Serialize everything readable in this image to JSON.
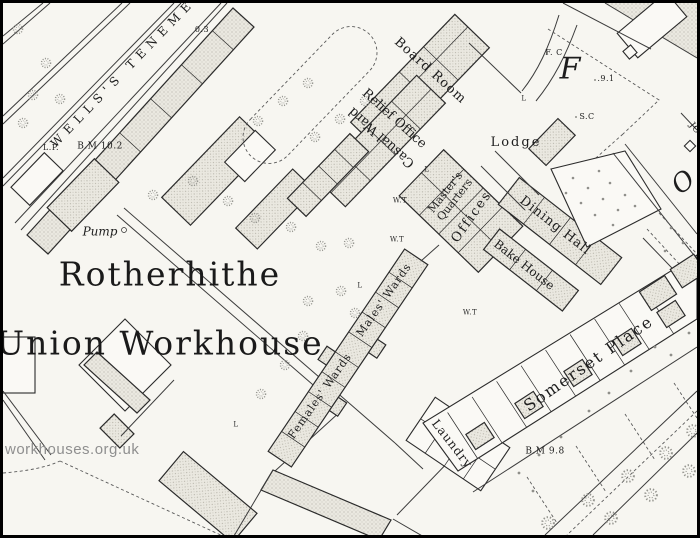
{
  "watermark": "workhouses.org.uk",
  "map": {
    "title": {
      "line1": "Rotherhithe",
      "line2": "Union Workhouse"
    },
    "streets": {
      "wells_tenements": "WELLS'S TENEME",
      "somerset_place": "Somerset Place",
      "big_letter_f": "F",
      "big_letter_o": "O",
      "edge_street_jo": "JO"
    },
    "buildings": {
      "board_room": "Board Room",
      "relief_office": "Relief Office",
      "casual_ward": "Casual Ward",
      "lodge": "Lodge",
      "masters_quarters_line1": "Master's",
      "masters_quarters_line2": "Quarters",
      "offices": "Offices",
      "dining_hall": "Dining Hall",
      "bake_house": "Bake House",
      "males_wards": "Males' Wards",
      "females_wards": "Females' Wards",
      "laundry": "Laundry"
    },
    "annotations": {
      "pump": "Pump",
      "lamp_post": "L.P.",
      "benchmark_102": "B.M 10.2",
      "benchmark_98": "B.M 9.8",
      "parcel_number": "0.3",
      "spot_height": ".9.1",
      "sc_marker": "S.C",
      "fc_marker": "F. C",
      "water_tap": "W.T",
      "lamp": "L"
    }
  },
  "colors": {
    "paper": "#f7f6f1",
    "ink": "#1d1d1d",
    "building_fill": "#eae8e0",
    "tree": "#94948e",
    "watermark": "#8f8f8f",
    "frame": "#000000"
  }
}
